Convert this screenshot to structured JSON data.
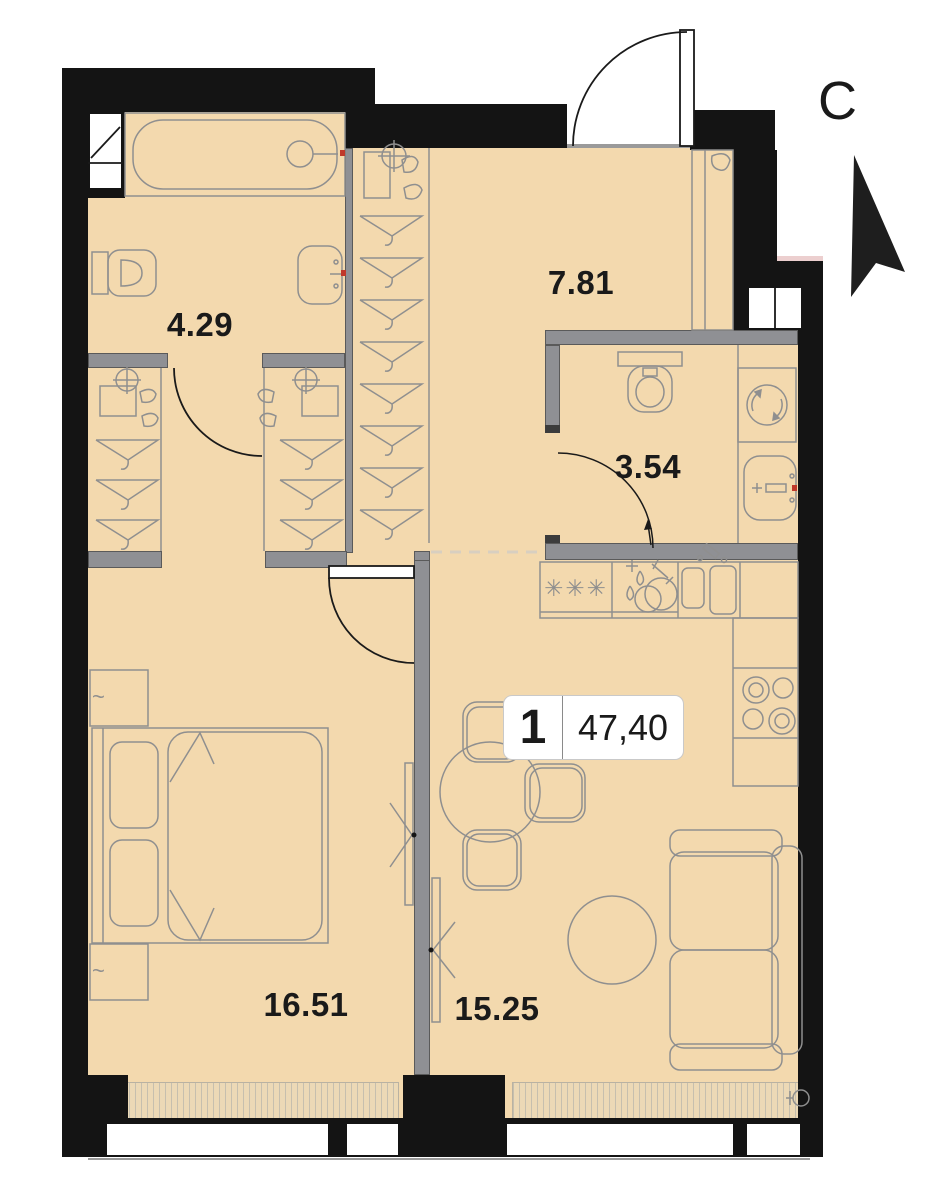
{
  "north": {
    "label": "С"
  },
  "unit_badge": {
    "rooms_count": "1",
    "total_area": "47,40"
  },
  "rooms": {
    "bathroom": {
      "area": "4.29"
    },
    "hallway": {
      "area": "7.81"
    },
    "wc": {
      "area": "3.54"
    },
    "bedroom": {
      "area": "16.51"
    },
    "kitchen_living": {
      "area": "15.25"
    }
  },
  "icons": {
    "fridge_symbol": "✳✳✳",
    "lamp_symbol": "~"
  },
  "colors": {
    "floor": "#f3d9ae",
    "wall": "#141414",
    "partition": "#8f9094",
    "furniture_line": "#8f8f8f",
    "accent_red": "#c0392b",
    "dashed_zone": "#d8cfc0"
  }
}
